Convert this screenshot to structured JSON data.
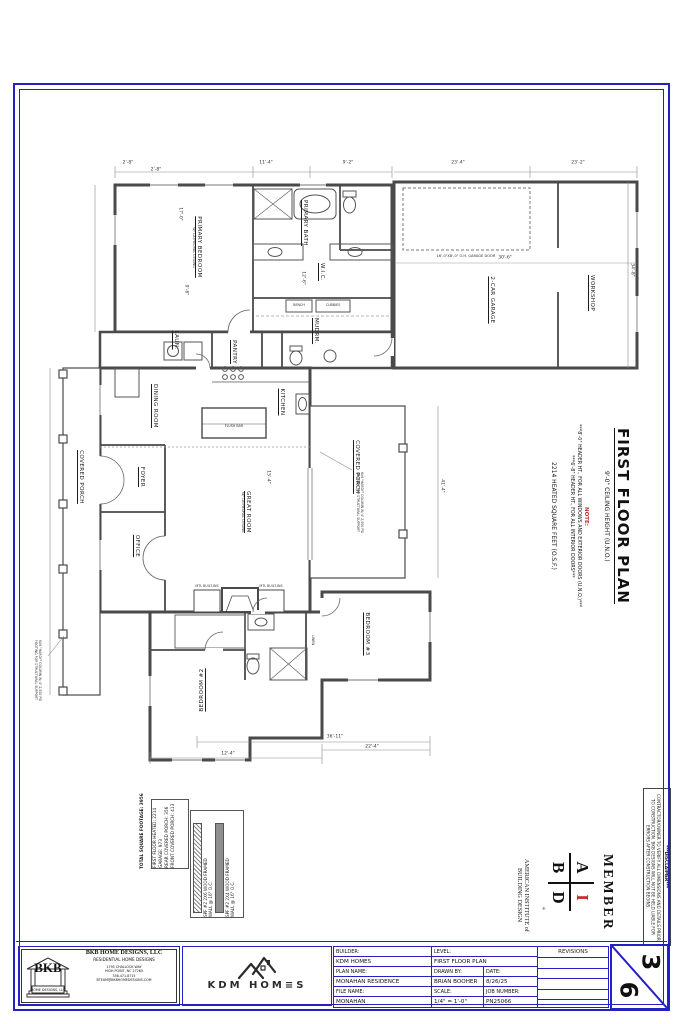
{
  "plan": {
    "rooms": {
      "primary_bedroom": "PRIMARY BEDROOM",
      "primary_bedroom_sub": "W/ CATHEDRAL CEILING",
      "primary_bath": "PRIMARY BATH",
      "wic": "W.I.C.",
      "laundry": "LAUN.",
      "pantry": "PANTRY",
      "mudroom": "MUDRM.",
      "garage": "2-CAR GARAGE",
      "workshop": "WORKSHOP",
      "dining": "DINING ROOM",
      "kitchen": "KITCHEN",
      "foyer": "FOYER",
      "office": "OFFICE",
      "great_room": "GREAT ROOM",
      "great_room_sub": "W/ CATHEDRAL CEILING",
      "covered_porch_front": "COVERED PORCH",
      "covered_porch_rear": "COVERED PORCH",
      "bedroom2": "BEDROOM #2",
      "bedroom3": "BEDROOM #3",
      "linen": "LINEN"
    },
    "fixtures": {
      "flush_bar": "FLUSH BAR",
      "bench": "BENCH",
      "cubbies": "CUBBIES",
      "builtins": "MTL BUILT-INS"
    },
    "notes": {
      "garage_door": "16'-0\"X8'-0\" O.H. GARAGE DOOR",
      "column": "6X6 \"HARDY\" COLUMN W/ 4' 2,500 PSI FOOTING FOR STRUCTURAL SUPPORT"
    },
    "dims": {
      "d0": "2'-8\"",
      "d1": "2'-8\"",
      "d2": "11'-4\"",
      "d3": "9'-2\"",
      "d4": "23'-4\"",
      "d5": "23'-2\"",
      "d6": "30'-6\"",
      "d7": "34'-8\"",
      "d8": "41'-4\"",
      "d9": "36'-11\"",
      "d10": "22'-4\"",
      "d11": "12'-4\"",
      "d12": "17'-0\"",
      "d13": "9'-6\"",
      "d14": "15'-4\"",
      "d15": "12'-6\""
    }
  },
  "margin": {
    "title": "FIRST FLOOR PLAN",
    "ceiling": "9'-0\" CEILING HEIGHT (U.N.O.)",
    "note_label": "NOTE:",
    "note1": "***8'-0\" HEADER HT., FOR ALL WINDOWS AND EXTERIOR DOORS (U.N.O.)***",
    "note2": "***6'-8\" HEADER HT., FOR ALL INTERIOR DOORS***",
    "sqft": "2214 HEATED SQUARE FEET (O.S.F.)"
  },
  "aibd": {
    "member": "MEMBER",
    "a": "A",
    "i": "I",
    "b": "B",
    "d": "D",
    "reg": "®",
    "org1": "AMERICAN INSTITUTE of",
    "org2": "BUILDING DESIGN"
  },
  "disclaimer": {
    "title": "***DISCLAIMER***",
    "body": "CONTRACTOR/OWNER TO VERIFY ALL DIMENSIONS AND DETAILS PRIOR TO CONSTRUCTION. BKB DESIGNS WILL NOT BE HELD LIABLE FOR ERRORS AFTER CONSTRUCTION BEGINS."
  },
  "sf": {
    "l1": "FIRST FLOOR HEATED: 2214",
    "l2": "GARAGE: 973",
    "l3": "REAR COVERED PORCH: 356",
    "l4": "FRONT COVERED PORCH: 413",
    "total": "TOTAL SQUARE FOOTAGE: 3956"
  },
  "legend": {
    "i1a": "SPF #2 2X6 WOOD FRAMED",
    "i1b": "WALL @ 16\" O.C.",
    "i2a": "SPF #2 2X4 WOOD FRAMED",
    "i2b": "WALL @ 16\" O.C."
  },
  "tb": {
    "bkb": {
      "logo": "BKB",
      "logo_sub": "HOME DESIGNS, LLC",
      "name": "BKB HOME DESIGNS, LLC",
      "tag": "RESIDENTIAL HOME DESIGNS",
      "addr1": "1795 CHALLOCK WAY",
      "addr2": "HIGH POINT, NC 27265",
      "addr3": "336.471.8715",
      "addr4": "BTEAM@BKBHOMEDESIGNS.COM"
    },
    "kdm": {
      "logo": "KDM HOM≡S"
    },
    "builder_label": "BUILDER:",
    "builder": "KDM HOMES",
    "level_label": "LEVEL:",
    "level": "FIRST FLOOR PLAN",
    "plan_label": "PLAN NAME:",
    "plan": "MONAHAN RESIDENCE",
    "drawn_label": "DRAWN BY:",
    "drawn": "BRIAN BOOHER",
    "date_label": "DATE:",
    "date": "8/26/25",
    "file_label": "FILE NAME:",
    "file": "MONAHAN",
    "scale_label": "SCALE:",
    "scale": "1/4\" = 1'-0\"",
    "job_label": "JOB NUMBER:",
    "job": "PN25066",
    "revisions": "REVISIONS",
    "sheet_num": "3",
    "sheet_den": "6"
  }
}
